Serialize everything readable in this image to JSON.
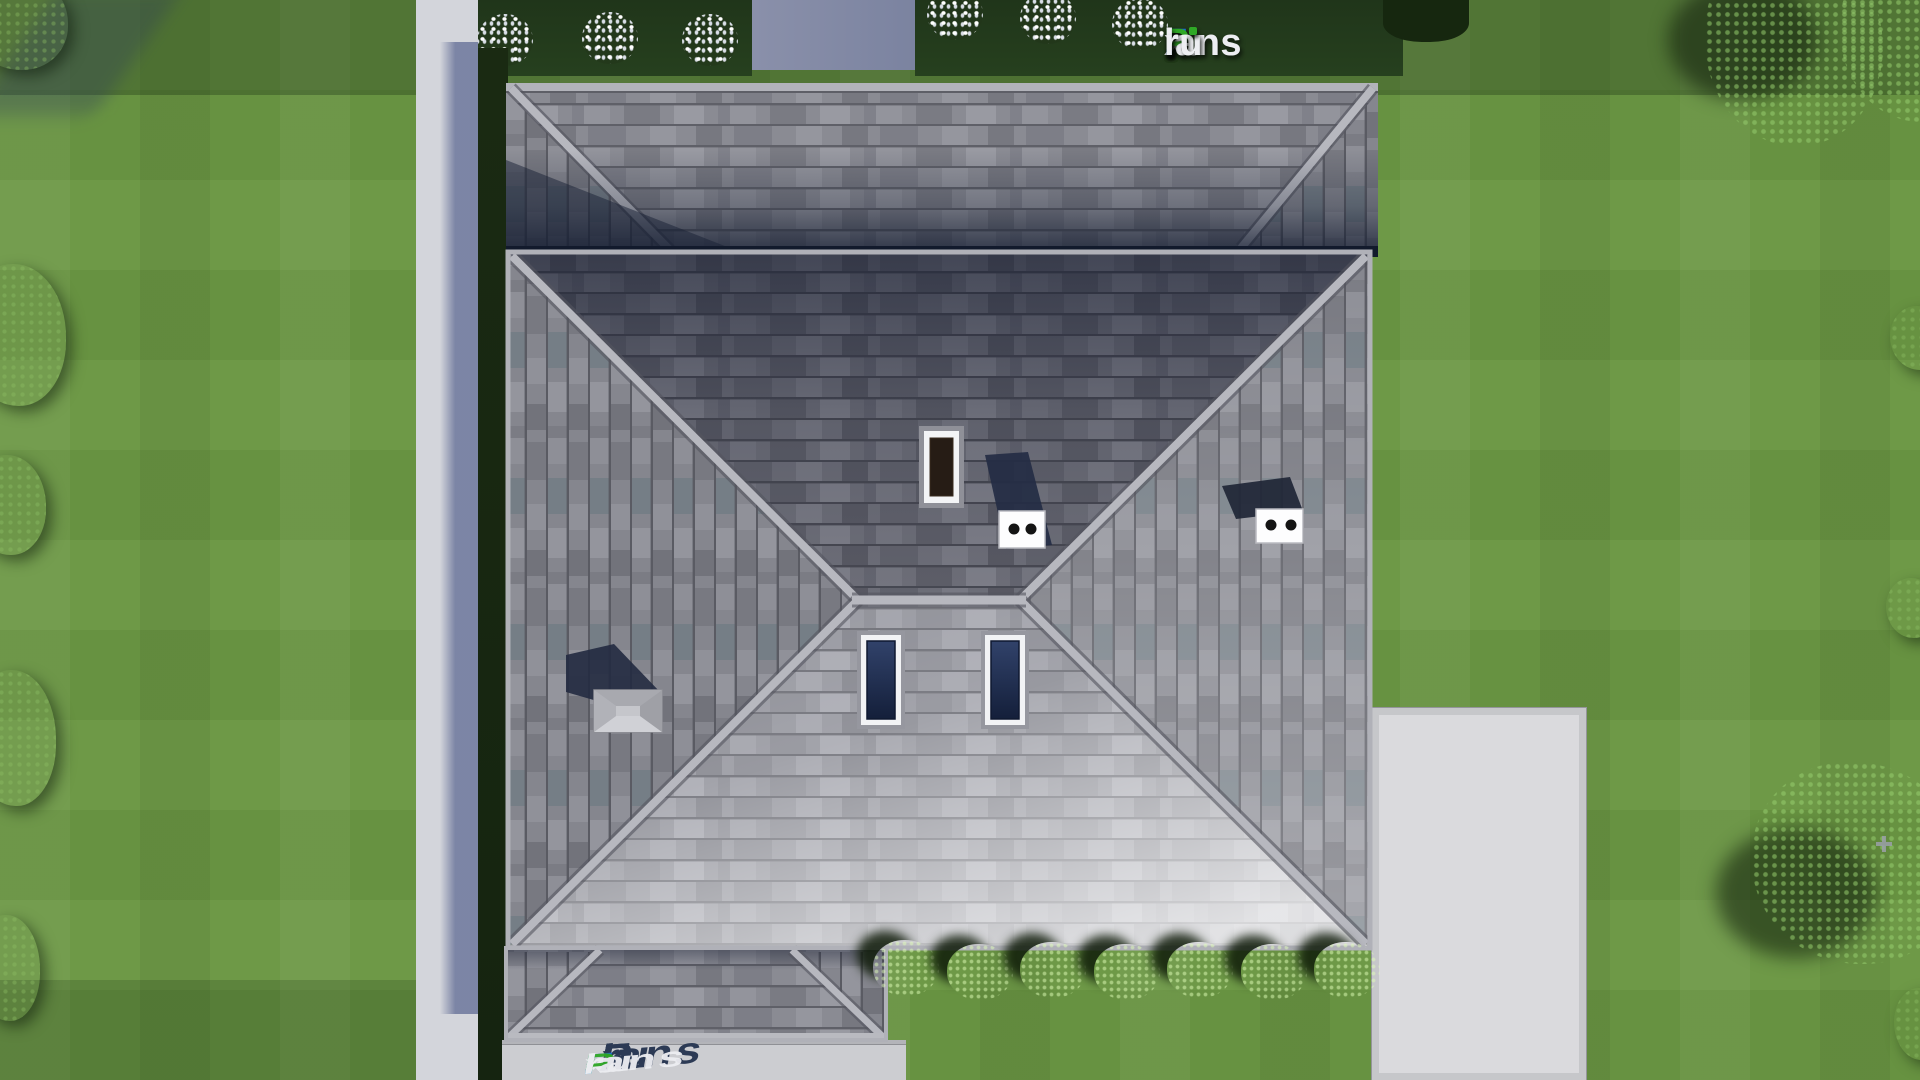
{
  "brand": {
    "logo_full_text": "FixPlans.ru",
    "i_dot_color": "#2fa826",
    "segments": [
      {
        "text": "F",
        "color": "#1d73e0"
      },
      {
        "text": "i",
        "color": "#edeef2"
      },
      {
        "text": "x",
        "color": "#edeef2"
      },
      {
        "text": "P",
        "color": "#2fa826"
      },
      {
        "text": "lans",
        "color": "#edeef2"
      },
      {
        "text": ".",
        "color": "#1d73e0"
      },
      {
        "text": "ru",
        "color": "#edeef2"
      }
    ]
  },
  "ground_watermark": {
    "text": "FixPlans.ru"
  },
  "scene": {
    "type": "aerial top-down 3D architectural render",
    "subject": "hip-roofed house with rear roof section, garage roof, lawn, sidewalk and concrete pads",
    "visible_objects": [
      "main hip roof with central ridge",
      "rear hip roof section with shadowed valley",
      "garage hip roof (bottom left)",
      "chimney with white frame",
      "two white double-flue roof vents",
      "pyramid roof vent",
      "two skylights with navy glass",
      "hedge bed with white flowering shrubs (top)",
      "row of green bushes (south side)",
      "trees along right edge",
      "dark bushes along left edge",
      "left sidewalk in building shadow",
      "concrete pad (right)",
      "driveway (bottom) with tilted watermark"
    ],
    "colors": {
      "lawn": "#6b9743",
      "hedge": "#233a1c",
      "roof_shingle": "#8a8b93",
      "roof_shingle_dark": "#6d6e78",
      "roof_shingle_light": "#96979f",
      "roof_cap": "#b7b8bf",
      "valley_shadow": "#121a2c",
      "skylight_glass": "#223356",
      "chimney_flue": "#261c15",
      "pavement": "#d3d5db",
      "pavement_shadow": "#7b83a0",
      "bush_green": "#74b544"
    }
  }
}
